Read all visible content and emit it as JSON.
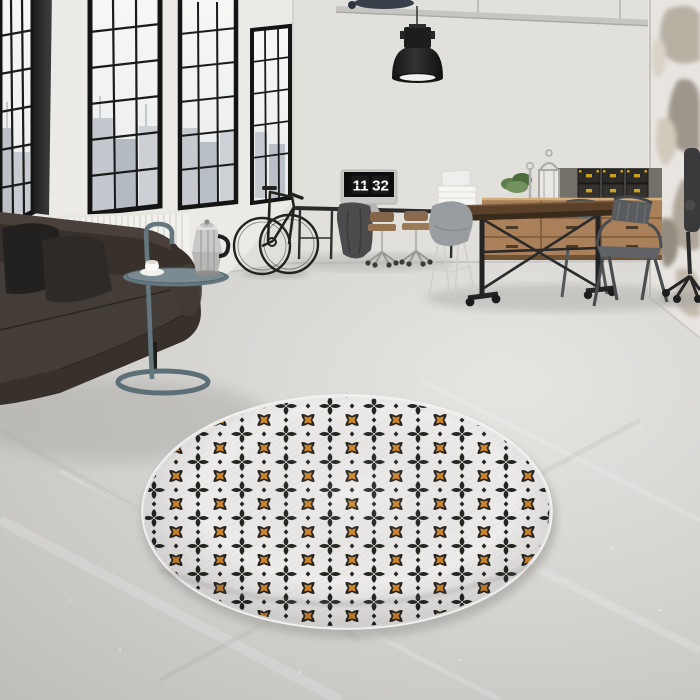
{
  "scene": {
    "setting": "Industrial loft interior, 3D-rendered product photo",
    "focus": "Round black, white and orange patterned area rug on concrete floor",
    "time_on_clock": "11:32"
  },
  "clock": {
    "hours": "11",
    "minutes": "32"
  },
  "palette": {
    "wall": "#dfddd8",
    "weathered_wall": "#e8e5e0",
    "floor": "#d6d5d2",
    "window_frame": "#161616",
    "glass": "#f3f4f4",
    "rug_base": "#edecea",
    "rug_motif": "#262522",
    "rug_accent": "#d2862b",
    "sofa_leather": "#38312b",
    "radiator": "#f2f1ed",
    "side_table": "#64767e",
    "moka_pot": "#c9c9c7",
    "wood_furniture": "#a9805a",
    "table_top": "#5b4129",
    "metal_chair": "#595c5f",
    "office_chair_seat": "#8f6f4f",
    "lamp": "#1d1d1d",
    "box_black": "#2d2b29",
    "box_brass": "#c9a227",
    "plant_green": "#5f7f4d"
  },
  "objects": [
    "black steel factory windows with city view",
    "white radiator",
    "dark brown leather sofa with two dark pillows",
    "blue-grey round tray side table",
    "steel moka espresso pot and white coffee cup",
    "black bicycle leaning on wall",
    "black industrial pendant lamp",
    "ceiling pipe",
    "monitor showing flip clock 11:32",
    "black desk with two tan office chairs and grey coat",
    "grey shell chair",
    "wooden sideboard with drawers",
    "black storage boxes with brass clasps",
    "potted green plant and silver lantern",
    "industrial wood-top dining table with cast-iron legs",
    "two gunmetal tolix armchairs",
    "black office chair at right edge",
    "weathered plaster wall",
    "round geometric area rug in black, white and orange"
  ]
}
